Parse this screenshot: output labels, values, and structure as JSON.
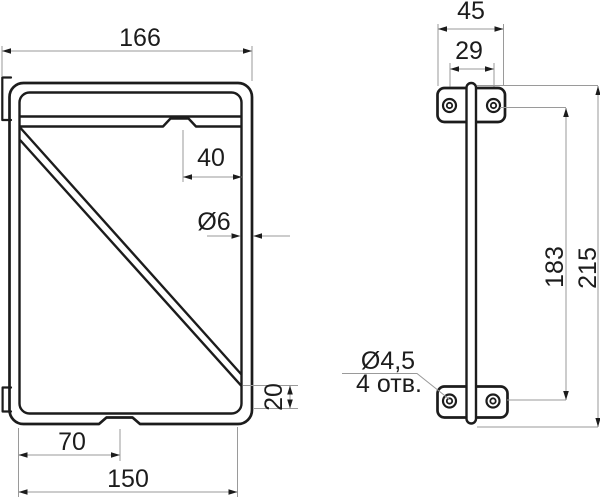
{
  "drawing": {
    "background": "#ffffff",
    "line_color": "#1c1c1c",
    "dim_line_color": "#9a9a9a",
    "front_view": {
      "dims": {
        "width_total": "166",
        "notch_offset": "40",
        "wire_diameter": "Ø6",
        "diagonal_end_height": "20",
        "bottom_notch_center": "70",
        "width_inner": "150"
      }
    },
    "side_view": {
      "dims": {
        "plate_width": "45",
        "hole_spacing": "29",
        "hole_centers_height": "183",
        "height_total": "215",
        "hole_diameter": "Ø4,5",
        "hole_count_note": "4 отв."
      }
    }
  }
}
